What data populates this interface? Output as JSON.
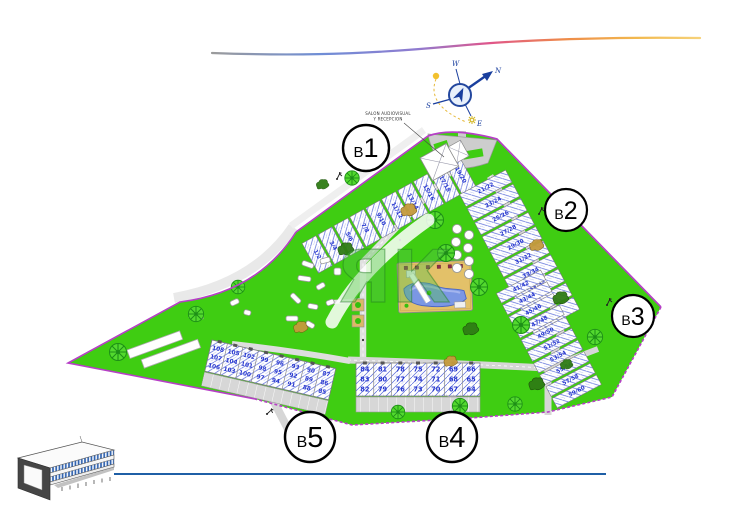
{
  "page": {
    "background": "#ffffff"
  },
  "decor": {
    "top_swoosh_colors": [
      "#9b9b9b",
      "#6f8ed6",
      "#8f7bd0",
      "#e0558a",
      "#ee8a4a",
      "#f2b94e",
      "#f6d27a"
    ],
    "bottom_line_color": "#1f5fa6"
  },
  "compass": {
    "n": "N",
    "s": "S",
    "e": "E",
    "w": "W"
  },
  "watermark": {
    "text": "ЯК"
  },
  "annotations": {
    "reception_line1": "SALON AUDIOVISUAL",
    "reception_line2": "Y RECEPCION"
  },
  "site": {
    "colors": {
      "grass": "#3fcd12",
      "boundary": "#b63fc6",
      "road": "#d6d6d6",
      "building_fill": "#ffffff",
      "roof_lines": "#5568d8",
      "unit_numbers": "#2636cf",
      "pool_water": "#7b97e4",
      "pool_deck": "#e3c169",
      "tree_green": "#1d8f17"
    }
  },
  "blocks": [
    {
      "id": "B1",
      "label_b": "B",
      "label_num": "1",
      "units": [
        "1/2",
        "3/4",
        "5/6",
        "7/8",
        "9/10",
        "11/12",
        "13/14",
        "15/16",
        "17/18",
        "19/20"
      ]
    },
    {
      "id": "B2",
      "label_b": "B",
      "label_num": "2",
      "units": [
        "21/22",
        "23/24",
        "25/26",
        "27/28",
        "29/30",
        "31/32",
        "33/34",
        "35/36",
        "37/38",
        "39/40"
      ]
    },
    {
      "id": "B3",
      "label_b": "B",
      "label_num": "3",
      "units": [
        "41/42",
        "43/44",
        "45/46",
        "47/48",
        "49/50",
        "51/52",
        "53/54",
        "55/56",
        "57/58",
        "59/60"
      ]
    },
    {
      "id": "B4",
      "label_b": "B",
      "label_num": "4",
      "units_stacked": [
        [
          "84",
          "83",
          "82"
        ],
        [
          "81",
          "80",
          "79"
        ],
        [
          "78",
          "77",
          "76"
        ],
        [
          "75",
          "74",
          "73"
        ],
        [
          "72",
          "71",
          "70"
        ],
        [
          "69",
          "68",
          "67"
        ],
        [
          "66",
          "65",
          "64"
        ]
      ]
    },
    {
      "id": "B5",
      "label_b": "B",
      "label_num": "5",
      "units_stacked": [
        [
          "108",
          "107",
          "106"
        ],
        [
          "105",
          "104",
          "103"
        ],
        [
          "102",
          "101",
          "100"
        ],
        [
          "99",
          "98",
          "97"
        ],
        [
          "96",
          "95",
          "94"
        ],
        [
          "93",
          "92",
          "91"
        ],
        [
          "90",
          "89",
          "88"
        ],
        [
          "87",
          "86",
          "85"
        ]
      ]
    }
  ]
}
